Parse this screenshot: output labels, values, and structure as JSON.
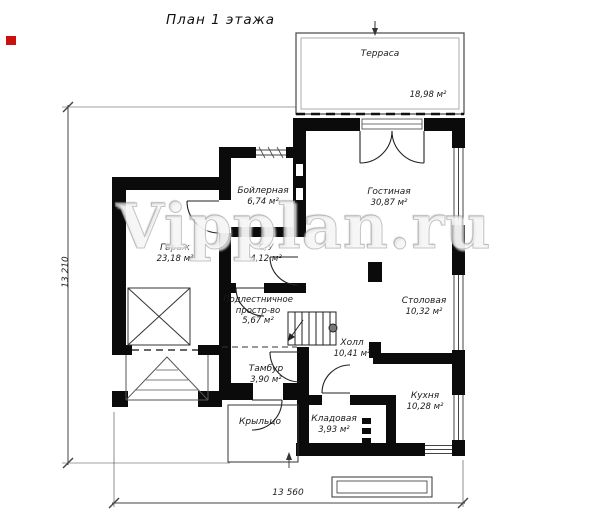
{
  "title": "План 1 этажа",
  "watermark": "Vipplan.ru",
  "colors": {
    "wall": "#0b0b0b",
    "marker_red": "#cc1010"
  },
  "rooms": [
    {
      "name": "Терраса",
      "area": "18,98 м²"
    },
    {
      "name": "Гостиная",
      "area": "30,87 м²"
    },
    {
      "name": "Бойлерная",
      "area": "6,74 м²"
    },
    {
      "name": "Гараж",
      "area": "23,18 м²"
    },
    {
      "name": "С/У",
      "area": "4,12 м²"
    },
    {
      "name": "Подлестничное",
      "name2": "простр-во",
      "area": "5,67 м²"
    },
    {
      "name": "Холл",
      "area": "10,41 м²"
    },
    {
      "name": "Столовая",
      "area": "10,32 м²"
    },
    {
      "name": "Кухня",
      "area": "10,28 м²"
    },
    {
      "name": "Тамбур",
      "area": "3,90 м²"
    },
    {
      "name": "Кладовая",
      "area": "3,93 м²"
    },
    {
      "name": "Крыльцо",
      "area": ""
    }
  ],
  "dimensions": {
    "left": "13 210",
    "bottom": "13 560"
  }
}
